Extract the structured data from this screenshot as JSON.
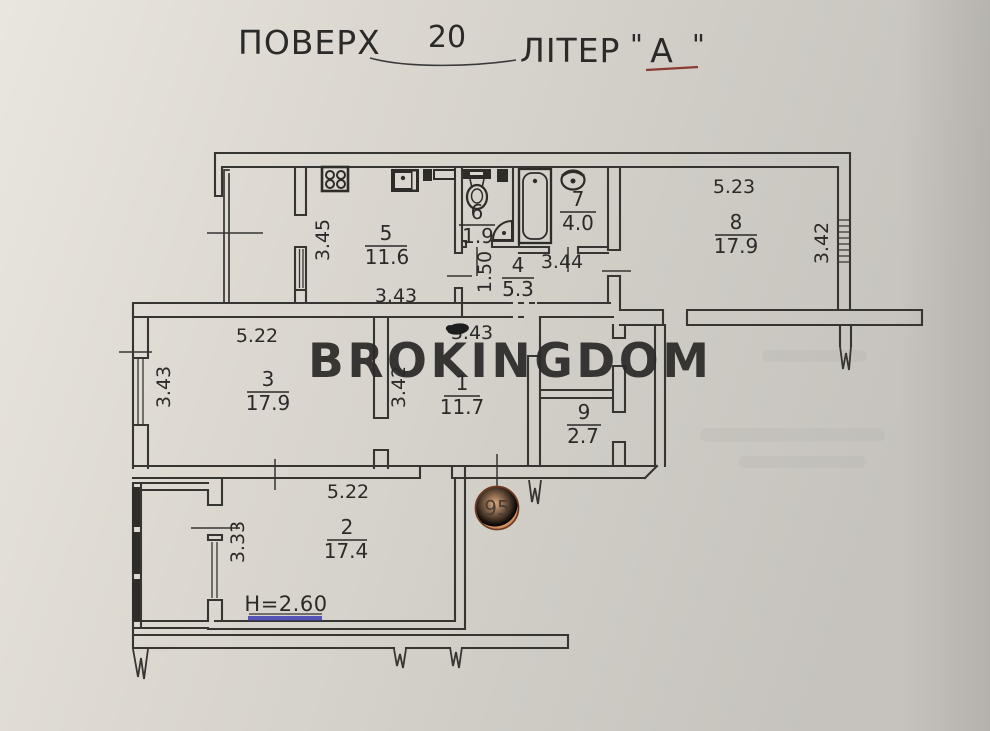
{
  "header": {
    "floor_label": "ПОВЕРХ",
    "floor_value": "20",
    "letter_label": "ЛІТЕР",
    "quote_open": "\"",
    "letter_value": "А",
    "quote_close": "\"",
    "letter_underline_color": "#8a3b33"
  },
  "watermark": {
    "text": "BROKINGDOM",
    "color": "#4d5f55"
  },
  "stamp": {
    "text": "95",
    "fill_center": "#e2ab80",
    "fill_edge": "#c5814f",
    "border": "#6f3b20"
  },
  "note": {
    "ceiling_height": "H=2.60",
    "underline_color": "#3e3eb0"
  },
  "rooms": {
    "r1": {
      "number": "1",
      "area": "11.7"
    },
    "r2": {
      "number": "2",
      "area": "17.4"
    },
    "r3": {
      "number": "3",
      "area": "17.9"
    },
    "r4": {
      "number": "4",
      "area": "5.3"
    },
    "r5": {
      "number": "5",
      "area": "11.6"
    },
    "r6": {
      "number": "6",
      "area": "1.9"
    },
    "r7": {
      "number": "7",
      "area": "4.0"
    },
    "r8": {
      "number": "8",
      "area": "17.9"
    },
    "r9": {
      "number": "9",
      "area": "2.7"
    }
  },
  "dims": {
    "kitchen_loggia_v": "3.45",
    "kitchen_w": "3.43",
    "hall_v": "1.50",
    "hall_w": "3.44",
    "room8_w": "5.23",
    "room8_v": "3.42",
    "room3_w": "5.22",
    "room3_v": "3.43",
    "room1_w": "3.43",
    "room1_v": "3.42",
    "room2_w": "5.22",
    "room2_v": "3.33"
  },
  "colors": {
    "paper": "#d8d5ce",
    "line": "#373532"
  }
}
